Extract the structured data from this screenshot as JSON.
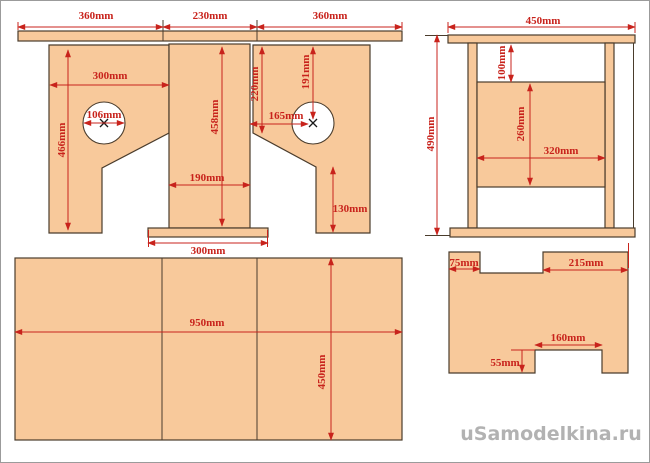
{
  "watermark": {
    "text": "uSamodelkina.ru"
  },
  "colors": {
    "wood_fill": "#F8C99B",
    "outline": "#4A3C2C",
    "dimension_red": "#C8231C",
    "watermark_gray": "#B2B2B2",
    "background": "#FFFFFF"
  },
  "views": {
    "front": {
      "dims": {
        "top_left": "360mm",
        "top_center": "230mm",
        "top_right": "360mm",
        "panel_width": "300mm",
        "hole_left_diameter": "106mm",
        "panel_height": "466mm",
        "column_height": "458mm",
        "column_width": "190mm",
        "right_edge_to_slant": "220mm",
        "hole_right_x": "165mm",
        "hole_right_y": "191mm",
        "foot_height": "130mm",
        "base_width": "300mm"
      }
    },
    "side": {
      "dims": {
        "width": "450mm",
        "height": "490mm",
        "top_gap": "100mm",
        "panel_height": "260mm",
        "panel_width": "320mm"
      }
    },
    "tabletop": {
      "dims": {
        "width": "950mm",
        "depth": "450mm"
      }
    },
    "shelf": {
      "dims": {
        "left_tab_width": "75mm",
        "right_top_width": "215mm",
        "notch_width": "160mm",
        "notch_height": "55mm"
      }
    }
  }
}
